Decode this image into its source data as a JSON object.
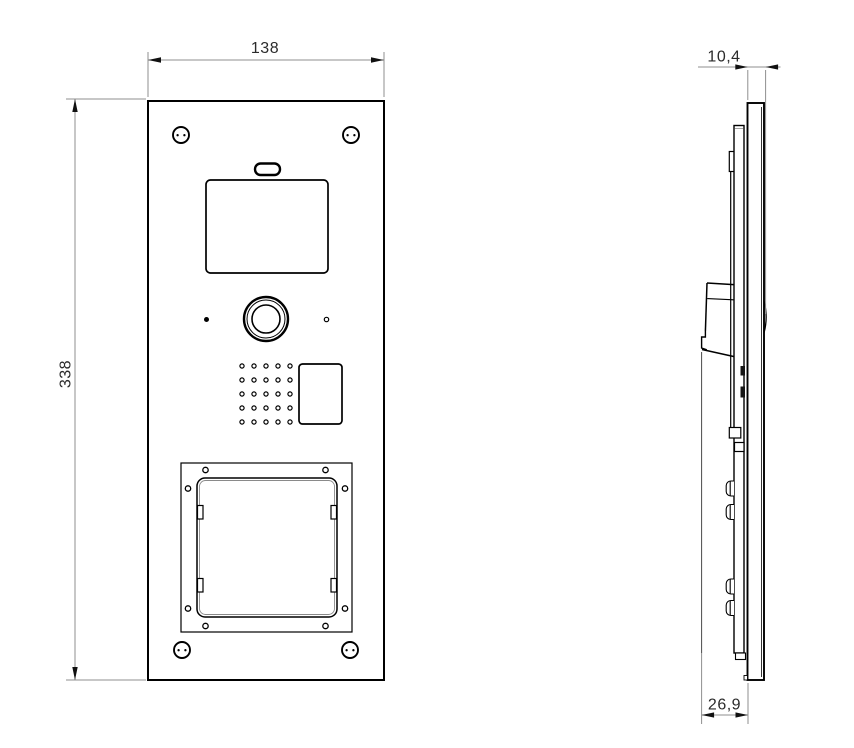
{
  "drawing": {
    "type": "technical-drawing",
    "colors": {
      "geometry": "#000000",
      "dimension_lines": "#8f8f8f",
      "dimension_text": "#2b2b2b",
      "background": "#ffffff"
    },
    "front_view": {
      "width_dimension": {
        "value": "138"
      },
      "height_dimension": {
        "value": "338"
      }
    },
    "side_view": {
      "thickness_dimension": {
        "value": "10,4"
      },
      "depth_dimension": {
        "value": "26,9"
      }
    }
  }
}
